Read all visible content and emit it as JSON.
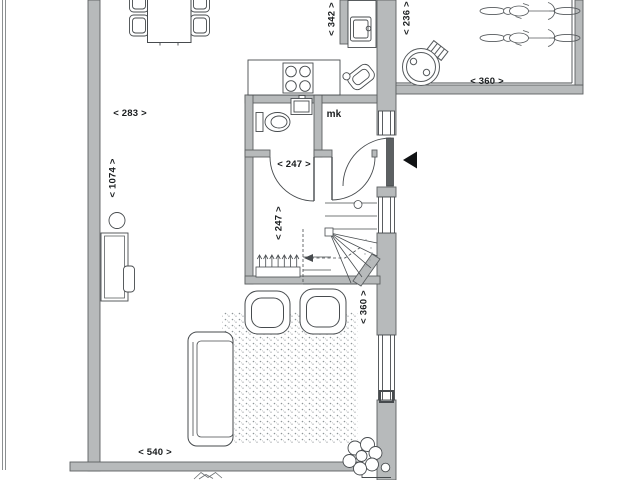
{
  "plan": {
    "type": "architectural floor plan, ground floor with living room, kitchen, hall, toilet, stairs and exterior bike storage",
    "labels": {
      "dim_283": "< 283 >",
      "dim_1074": "< 1074 >",
      "dim_342": "< 342 >",
      "dim_236": "< 236 >",
      "dim_360_storage": "< 360 >",
      "dim_247_width": "< 247 >",
      "dim_247_depth": "< 247 >",
      "dim_360_living": "< 360 >",
      "dim_540": "< 540 >",
      "meter_cupboard": "mk"
    },
    "colors": {
      "background": "#ffffff",
      "wall_fill": "#b7babb",
      "wall_edge": "#5c6062",
      "line": "#474b4e",
      "text": "#191c1e",
      "door_panel": "#5c6062",
      "entrance_arrow": "#101214"
    },
    "icons": [
      "dining-table-icon",
      "dining-chair-icon",
      "kitchen-counter-icon",
      "cooktop-icon",
      "kitchen-sink-icon",
      "utility-object-icon",
      "toilet-icon",
      "washbasin-icon",
      "stairs-icon",
      "walking-line",
      "coat-rack-icon",
      "sofa-icon",
      "armchair-icon",
      "rug",
      "desk-icon",
      "desk-chair-icon",
      "floor-lamp-icon",
      "plant-icon",
      "side-table-icon",
      "floor-plant-icon",
      "bicycle-icon",
      "waste-bin-icon",
      "entrance-arrow-icon",
      "front-door-icon",
      "interior-door-icon",
      "window-icon"
    ]
  }
}
